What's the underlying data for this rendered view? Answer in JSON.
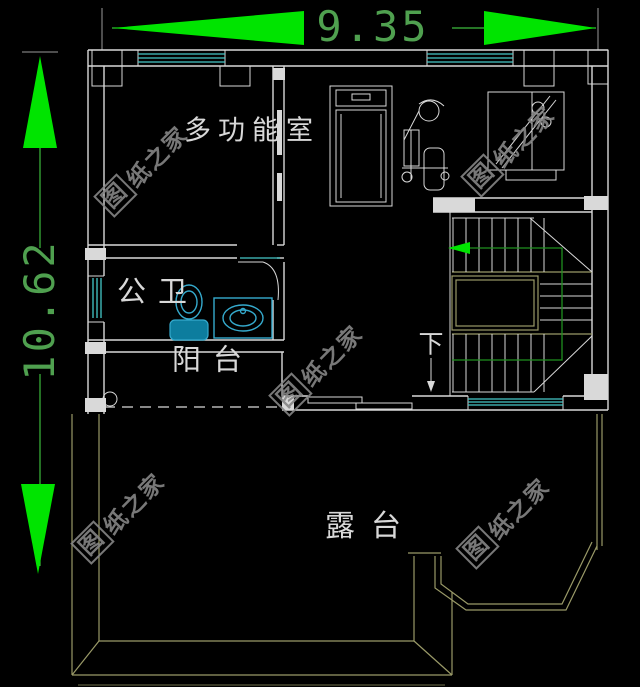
{
  "canvas": {
    "width": 640,
    "height": 687
  },
  "dimensions": {
    "width": "9.35",
    "height": "10.62"
  },
  "labels": {
    "multi_function_room": "多功能室",
    "public_bathroom": "公卫",
    "balcony": "阳台",
    "terrace": "露台",
    "stairs_down": "下"
  },
  "watermark": {
    "boxed_char": "图",
    "tail": "纸之家",
    "full_text": "图纸之家"
  },
  "fixtures": [
    "treadmill",
    "exercise-bike",
    "weight-machine",
    "toilet",
    "wash-basin",
    "u-shaped-staircase",
    "sliding-door",
    "door-swing"
  ],
  "colors": {
    "background": "#000000",
    "wall_line": "#d9d9d9",
    "window_line": "#45c8c8",
    "dimension_arrow": "#00e400",
    "dimension_text": "#4fa04f",
    "terrace_line": "#9a9a68",
    "stair_rail": "#1f8f1f",
    "fixture_line": "#35aacd",
    "fixture_fill": "#0d7d9e",
    "watermark": "#868686"
  }
}
